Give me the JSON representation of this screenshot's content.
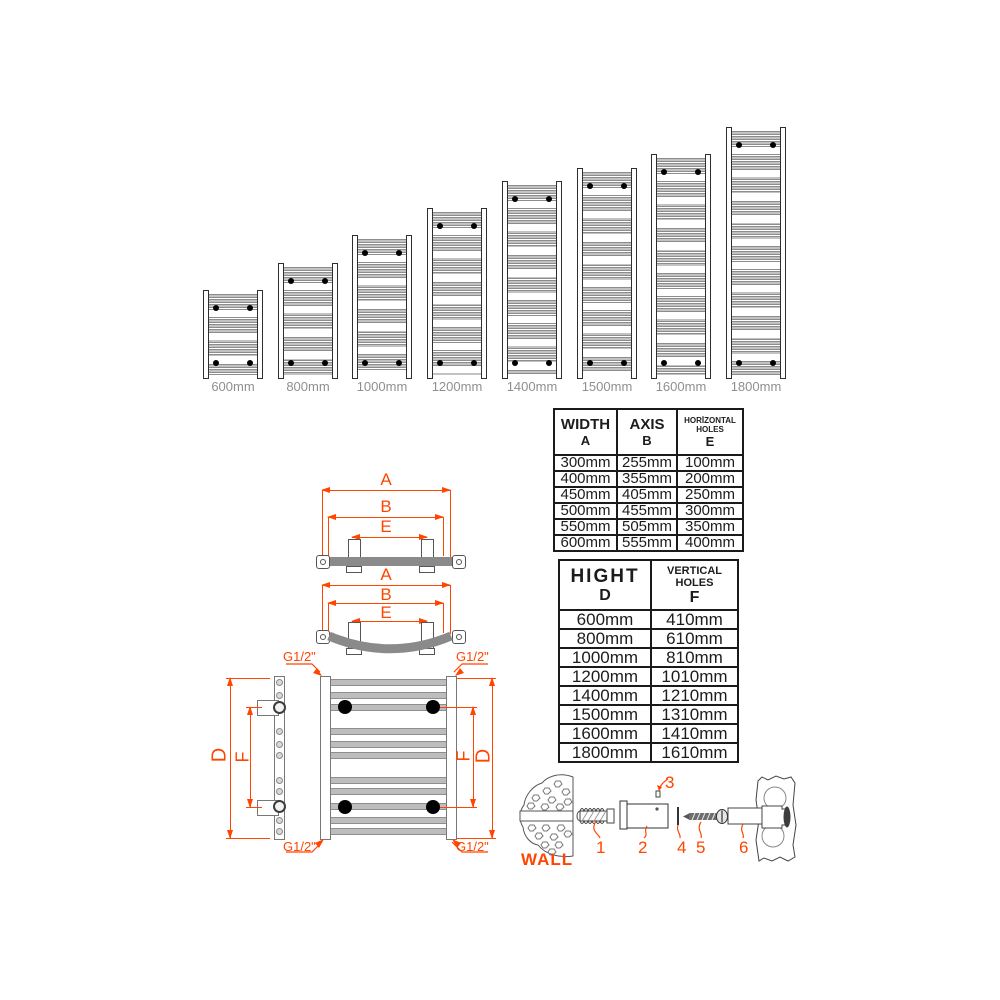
{
  "radiators": {
    "items": [
      {
        "label": "600mm"
      },
      {
        "label": "800mm"
      },
      {
        "label": "1000mm"
      },
      {
        "label": "1200mm"
      },
      {
        "label": "1400mm"
      },
      {
        "label": "1500mm"
      },
      {
        "label": "1600mm"
      },
      {
        "label": "1800mm"
      }
    ]
  },
  "width_table": {
    "columns": [
      {
        "title": "WIDTH",
        "letter": "A"
      },
      {
        "title": "AXIS",
        "letter": "B"
      },
      {
        "title": "HORİZONTAL HOLES",
        "letter": "E"
      }
    ],
    "rows": [
      [
        "300mm",
        "255mm",
        "100mm"
      ],
      [
        "400mm",
        "355mm",
        "200mm"
      ],
      [
        "450mm",
        "405mm",
        "250mm"
      ],
      [
        "500mm",
        "455mm",
        "300mm"
      ],
      [
        "550mm",
        "505mm",
        "350mm"
      ],
      [
        "600mm",
        "555mm",
        "400mm"
      ]
    ]
  },
  "height_table": {
    "columns": [
      {
        "title": "HIGHT",
        "letter": "D"
      },
      {
        "title": "VERTICAL HOLES",
        "letter": "F"
      }
    ],
    "rows": [
      [
        "600mm",
        "410mm"
      ],
      [
        "800mm",
        "610mm"
      ],
      [
        "1000mm",
        "810mm"
      ],
      [
        "1200mm",
        "1010mm"
      ],
      [
        "1400mm",
        "1210mm"
      ],
      [
        "1500mm",
        "1310mm"
      ],
      [
        "1600mm",
        "1410mm"
      ],
      [
        "1800mm",
        "1610mm"
      ]
    ]
  },
  "dims": {
    "a": "A",
    "b": "B",
    "e": "E",
    "d": "D",
    "f": "F",
    "thread": "G1/2\""
  },
  "hardware": {
    "wall_label": "WALL",
    "parts": [
      "1",
      "2",
      "3",
      "4",
      "5",
      "6"
    ]
  },
  "colors": {
    "accent": "#ff4500",
    "size_label_gray": "#8f8f8f"
  }
}
